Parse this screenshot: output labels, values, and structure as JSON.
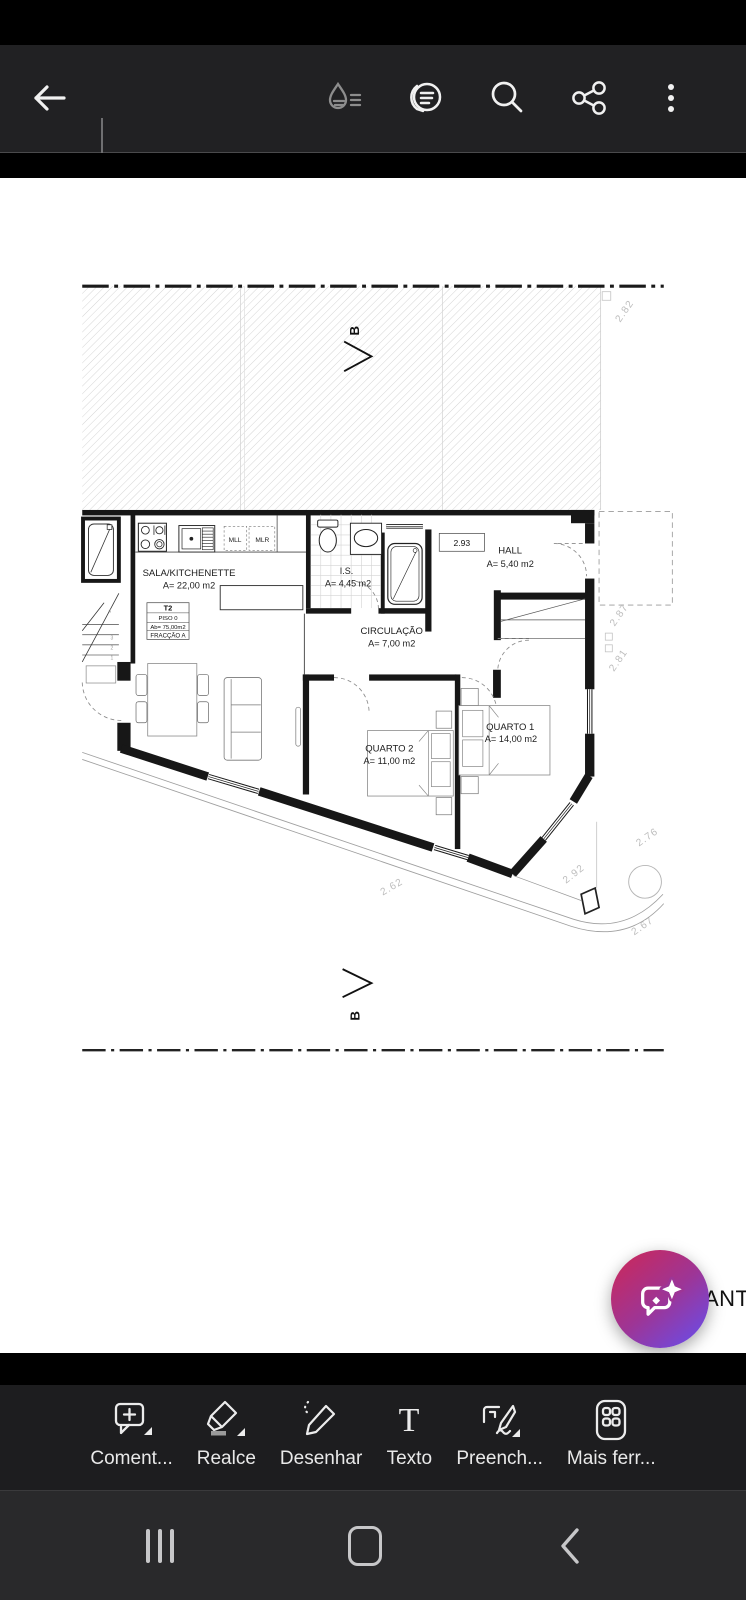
{
  "top_toolbar": {
    "icons": [
      "back-arrow",
      "ink-drop",
      "view-settings",
      "search",
      "share",
      "more-options"
    ]
  },
  "floor_plan": {
    "section_label": "B",
    "rooms": [
      {
        "name": "SALA/KITCHENETTE",
        "area": "A= 22,00 m2"
      },
      {
        "name": "I.S.",
        "area": "A= 4,45 m2"
      },
      {
        "name": "HALL",
        "area": "A= 5,40 m2"
      },
      {
        "name": "CIRCULAÇÃO",
        "area": "A= 7,00 m2"
      },
      {
        "name": "QUARTO 1",
        "area": "A= 14,00 m2"
      },
      {
        "name": "QUARTO 2",
        "area": "A= 11,00 m2"
      }
    ],
    "unit_info": {
      "type": "T2",
      "floor": "PISO 0",
      "gross_area": "Ab= 75,00m2",
      "fraction": "FRACÇÃO A"
    },
    "appliance_labels": {
      "left": "MLL",
      "right": "MLR"
    },
    "level_ref": "2.93",
    "dimensions": {
      "top_right": "2.82",
      "right_upper": "2.87",
      "right_lower": "2.81",
      "southeast": "2.76",
      "bottom_right": "2.92",
      "corner": "2.67",
      "bottom_left": "2.62"
    },
    "stair_numbers": [
      "1",
      "2",
      "3",
      "4"
    ],
    "clipped_text": "ANTA"
  },
  "fab": {
    "icon": "ai-chat-sparkle",
    "gradient_start": "#c7295f",
    "gradient_end": "#6a4ce8"
  },
  "tool_bar": {
    "tools": [
      {
        "label": "Coment..."
      },
      {
        "label": "Realce"
      },
      {
        "label": "Desenhar"
      },
      {
        "label": "Texto"
      },
      {
        "label": "Preench..."
      },
      {
        "label": "Mais ferr..."
      }
    ]
  },
  "nav_bar": {
    "icons": [
      "recents",
      "home",
      "back"
    ]
  }
}
